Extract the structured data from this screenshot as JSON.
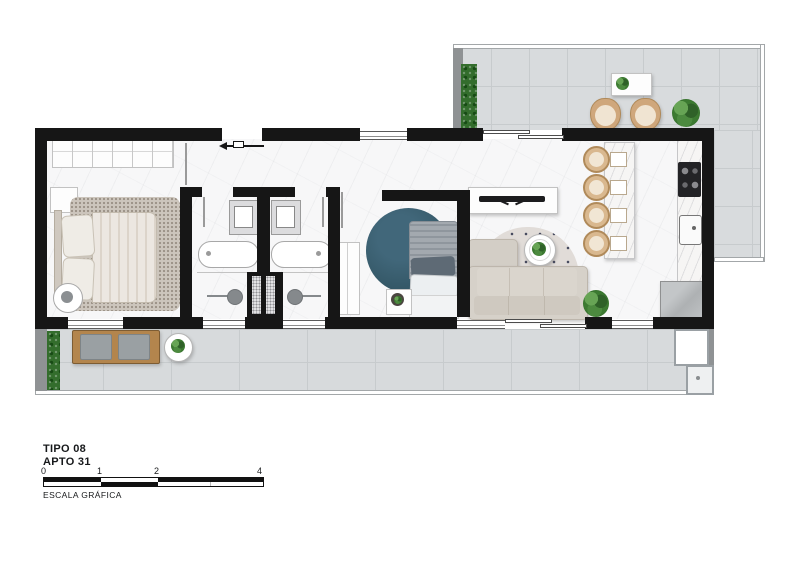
{
  "title_block": {
    "line1": "TIPO 08",
    "line2": "APTO 31"
  },
  "scale_bar": {
    "ticks": [
      "0",
      "1",
      "2",
      "4"
    ],
    "caption": "ESCALA GRÁFICA"
  },
  "colors": {
    "wall": "#161616",
    "interior_floor": "#f7f7f8",
    "balcony_floor": "#d8dbdd",
    "rug_teal": "#345766",
    "wood": "#b3854d",
    "sofa": "#d6d1c9",
    "plant_green": "#3c7a31"
  }
}
